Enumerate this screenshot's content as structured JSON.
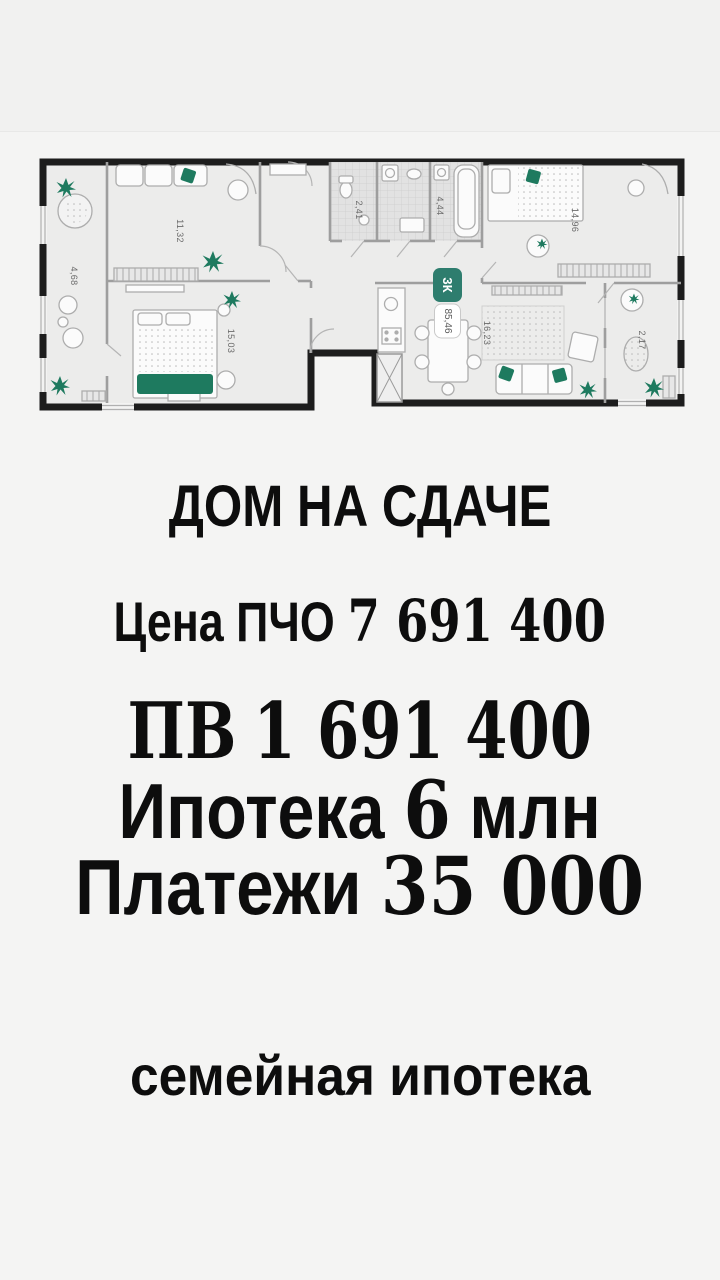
{
  "page": {
    "background": "#f3f3f2"
  },
  "floor_plan": {
    "badge": {
      "type": "3К",
      "area": "85,46"
    },
    "rooms": [
      {
        "id": "living-room",
        "area": "11,32"
      },
      {
        "id": "balcony-left",
        "area": "4,68"
      },
      {
        "id": "bedroom-left",
        "area": "15,03"
      },
      {
        "id": "bathroom-small",
        "area": "2,41"
      },
      {
        "id": "bathroom-large",
        "area": "4,44"
      },
      {
        "id": "bedroom-right",
        "area": "14,96"
      },
      {
        "id": "kitchen-living-room",
        "area": "16,23"
      },
      {
        "id": "balcony-right",
        "area": "2,17"
      }
    ],
    "colors": {
      "wall": "#1d1d1d",
      "accent_green": "#1e7a5f",
      "badge_teal": "#2e7d6e"
    }
  },
  "listing": {
    "title": "ДОМ НА СДАЧЕ",
    "price": {
      "label": "Цена ПЧО",
      "value": "7 691 400"
    },
    "down_payment": {
      "label": "ПВ",
      "value": "1 691 400"
    },
    "mortgage": {
      "label": "Ипотека",
      "value": "6",
      "unit": "млн"
    },
    "monthly_payment": {
      "label": "Платежи",
      "value": "35 000"
    },
    "footer": "семейная ипотека"
  }
}
